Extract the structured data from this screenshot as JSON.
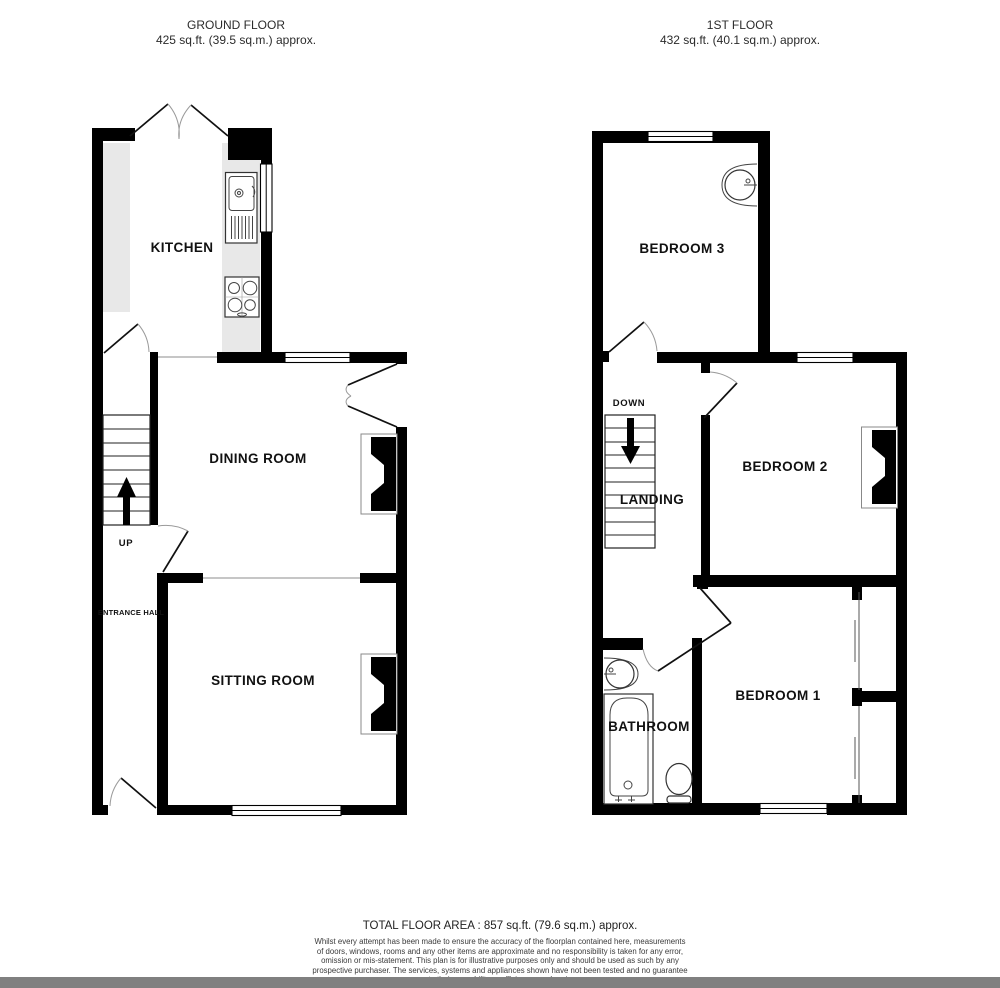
{
  "header": {
    "ground_floor": {
      "title": "GROUND FLOOR",
      "area": "425 sq.ft. (39.5 sq.m.) approx."
    },
    "first_floor": {
      "title": "1ST FLOOR",
      "area": "432 sq.ft. (40.1 sq.m.) approx."
    }
  },
  "ground_floor": {
    "rooms": {
      "kitchen": "KITCHEN",
      "dining": "DINING ROOM",
      "sitting": "SITTING ROOM",
      "hall": "ENTRANCE HALL",
      "stair_direction": "UP"
    }
  },
  "first_floor": {
    "rooms": {
      "bedroom3": "BEDROOM 3",
      "bedroom2": "BEDROOM 2",
      "bedroom1": "BEDROOM 1",
      "landing": "LANDING",
      "bathroom": "BATHROOM",
      "stair_direction": "DOWN"
    }
  },
  "footer": {
    "total": "TOTAL FLOOR AREA : 857 sq.ft. (79.6 sq.m.) approx.",
    "disclaimer_lines": [
      "Whilst every attempt has been made to ensure the accuracy of the floorplan contained here, measurements",
      "of doors, windows, rooms and any other items are approximate and no responsibility is taken for any error,",
      "omission or mis-statement. This plan is for illustrative purposes only and should be used as such by any",
      "prospective purchaser. The services, systems and appliances shown have not been tested and no guarantee",
      "as to their operability or efficiency can be given."
    ]
  },
  "colors": {
    "wall": "#000000",
    "counter": "#e8e8e8",
    "window": "#ffffff",
    "footer_bar": "#808080",
    "text": "#1a1a1a"
  }
}
